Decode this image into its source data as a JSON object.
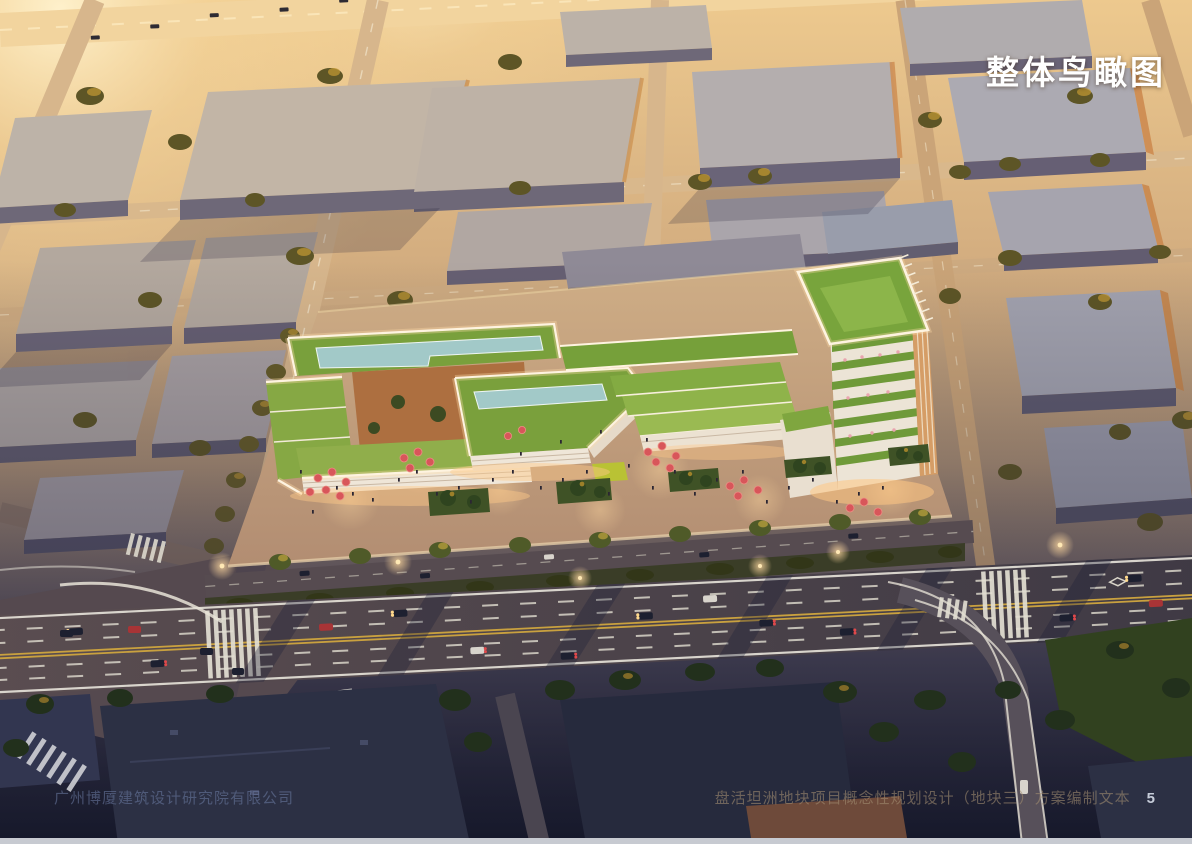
{
  "slide": {
    "title": "整体鸟瞰图",
    "footer_left": "广州博厦建筑设计研究院有限公司",
    "footer_right": "盘活坦洲地块项目概念性规划设计（地块三）方案编制文本",
    "page_number": "5"
  },
  "palette": {
    "sunset_glare": "#fff3cf",
    "ground_warm": "#d4ae80",
    "ground_dusk": "#23263a",
    "roof_grey": "#bdb3a8",
    "facade_shadow": "#6e6878",
    "facade_sunlit": "#cf9657",
    "site_green": "#7aa03c",
    "pool_teal": "#a2c9c8",
    "parapet_white": "#fef3e0",
    "plaza_warm": "#cfae86",
    "umbrella_red": "#d8565a",
    "asphalt": "#4a434e",
    "lane_yellow": "#c9a13f",
    "tree_olive": "#5d5526",
    "tree_gold": "#c49a33",
    "night_roof": "#2c3044",
    "headlight_glow": "#ffd98c",
    "taillight_red": "#e0484a"
  }
}
